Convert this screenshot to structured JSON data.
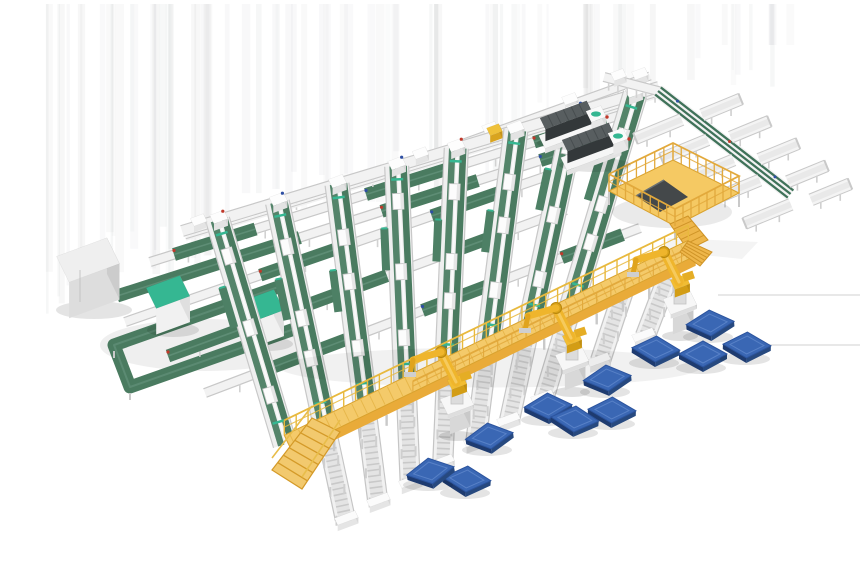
{
  "scene": {
    "canvas": {
      "width": 860,
      "height": 580,
      "background": "#ffffff"
    },
    "palette": {
      "belt_green": "#4a7b60",
      "belt_green_light": "#63927a",
      "belt_green_dark": "#3f7259",
      "teal_accent": "#35b792",
      "rail_white": "#f2f2f2",
      "rail_edge": "#c8c8c8",
      "roller_gray": "#e4e4e4",
      "walkway_deck": "#f4ca6a",
      "walkway_face": "#e9ab39",
      "walkway_trim": "#d9a22e",
      "robot_yellow": "#efb52c",
      "robot_shade": "#c79312",
      "pallet_top": "#3a67b4",
      "pallet_side_dark": "#1e3b70",
      "pallet_side": "#27497f",
      "machine_dark_top": "#585e60",
      "machine_dark_front": "#33383a",
      "machine_dark_side": "#272b2d",
      "dot_red": "#c0392b",
      "dot_blue": "#2e4fa3",
      "accent_yellow_box": "#efc13a",
      "shadow": "#000000"
    },
    "streaks": {
      "count": 78,
      "x_min": 45,
      "x_max": 790,
      "y_top": 4,
      "base_opacity": 0.032
    },
    "faint_lines": [
      {
        "x1": 718,
        "y1": 295,
        "x2": 860,
        "y2": 295
      },
      {
        "x1": 745,
        "y1": 345,
        "x2": 860,
        "y2": 345
      }
    ],
    "rows": [
      {
        "name": "infeed-line-upper",
        "p1": [
          450,
          148
        ],
        "p2": [
          650,
          76
        ],
        "w": 8,
        "boxes": [
          0.2,
          0.6,
          0.95
        ],
        "green": []
      },
      {
        "name": "cross-row-1",
        "p1": [
          150,
          262
        ],
        "p2": [
          630,
          112
        ],
        "w": 9,
        "boxes": [],
        "green": [
          [
            0.05,
            0.22
          ],
          [
            0.45,
            0.62
          ],
          [
            0.8,
            0.95
          ]
        ]
      },
      {
        "name": "cross-row-2",
        "p1": [
          117,
          296
        ],
        "p2": [
          598,
          142
        ],
        "w": 9,
        "boxes": [],
        "green": [
          [
            0.0,
            0.38
          ],
          [
            0.55,
            0.75
          ],
          [
            0.88,
            1.0
          ]
        ]
      },
      {
        "name": "cross-row-3",
        "p1": [
          125,
          322
        ],
        "p2": [
          576,
          166
        ],
        "w": 9,
        "boxes": [],
        "green": [
          [
            0.3,
            0.5
          ],
          [
            0.68,
            0.84
          ]
        ]
      },
      {
        "name": "cross-row-4",
        "p1": [
          168,
          356
        ],
        "p2": [
          566,
          210
        ],
        "w": 9,
        "boxes": [],
        "green": [
          [
            0.0,
            0.55
          ],
          [
            0.7,
            0.85
          ]
        ]
      },
      {
        "name": "cross-row-5",
        "p1": [
          205,
          393
        ],
        "p2": [
          640,
          228
        ],
        "w": 9,
        "boxes": [],
        "green": [
          [
            0.15,
            0.35
          ],
          [
            0.5,
            0.68
          ],
          [
            0.82,
            0.96
          ]
        ]
      }
    ],
    "infeed_main": {
      "name": "infeed-line-top",
      "p1": [
        182,
        231
      ],
      "p2": [
        659,
        87
      ],
      "w": 11,
      "extra_boxes": [
        0.035,
        0.5
      ],
      "yellow_box_t": 0.655
    },
    "corner_rail": {
      "p1": [
        604,
        77
      ],
      "p2": [
        662,
        92
      ],
      "w": 9,
      "box_t": 0.25
    },
    "lanes": {
      "count": 8,
      "t_start": 0.075,
      "t_step": 0.125,
      "lean_start": 0.3,
      "lean_end": -0.3,
      "width": 24,
      "shuttle_fracs": [
        0.16,
        0.44,
        0.7
      ],
      "chute_len": 42,
      "chute_offset": 15
    },
    "walkway": {
      "name": "elevated-walkway",
      "p1": [
        288,
        443
      ],
      "p2": [
        692,
        248
      ],
      "deck_w": 17,
      "face_h": 10,
      "rail_h": 15,
      "leg_step": 26,
      "stairs": [
        [
          312,
          418
        ],
        [
          340,
          432
        ],
        [
          302,
          489
        ],
        [
          272,
          470
        ]
      ],
      "end_ramp": [
        [
          688,
          241
        ],
        [
          712,
          252
        ],
        [
          700,
          266
        ],
        [
          680,
          252
        ]
      ]
    },
    "outfeeds": {
      "lane_indices": [
        1,
        2,
        3,
        4,
        5,
        6,
        7
      ],
      "extra_s": [
        0.84,
        0.96
      ],
      "length": 84,
      "width": 20
    },
    "loop": {
      "name": "left-loop-conveyor",
      "corners": [
        [
          114,
          345
        ],
        [
          284,
          285
        ],
        [
          300,
          327
        ],
        [
          130,
          387
        ]
      ],
      "belt_w": 13
    },
    "cabinet": {
      "name": "electrical-cabinet",
      "cx": 88,
      "cy": 296,
      "L": 54,
      "D": 30,
      "H": 36
    },
    "teal_boxes": [
      {
        "cx": 168,
        "cy": 318,
        "L": 36,
        "D": 24,
        "H": 26
      },
      {
        "cx": 262,
        "cy": 332,
        "L": 36,
        "D": 24,
        "H": 26
      }
    ],
    "machines": [
      {
        "name": "wrapper-machine-1",
        "cx": 569,
        "cy": 133
      },
      {
        "name": "wrapper-machine-2",
        "cx": 591,
        "cy": 155
      }
    ],
    "spur": {
      "name": "takeaway-spur-conveyor",
      "p1": [
        658,
        91
      ],
      "p2": [
        788,
        192
      ],
      "w": 14,
      "tables_low": [
        0.22,
        0.42,
        0.62,
        0.82,
        1.06
      ],
      "tables_high": [
        0.3,
        0.52,
        0.74,
        0.96,
        1.14
      ],
      "table_len_low": 50,
      "table_len_high": 42,
      "table_w": 12
    },
    "platform": {
      "name": "operator-platform",
      "floor": [
        [
          609,
          191
        ],
        [
          673,
          160
        ],
        [
          739,
          193
        ],
        [
          675,
          226
        ]
      ],
      "wedge": [
        [
          636,
          196
        ],
        [
          664,
          180
        ],
        [
          688,
          197
        ],
        [
          660,
          212
        ]
      ],
      "stairs": [
        [
          670,
          224
        ],
        [
          688,
          216
        ],
        [
          708,
          240
        ],
        [
          688,
          250
        ]
      ],
      "rail_h": 17
    },
    "robots": [
      {
        "name": "palletizing-robot-1",
        "x": 457,
        "y": 432
      },
      {
        "name": "palletizing-robot-2",
        "x": 572,
        "y": 388
      },
      {
        "name": "palletizing-robot-3",
        "x": 680,
        "y": 332
      }
    ],
    "pallets": [
      {
        "x": 710,
        "y": 321,
        "r": -4
      },
      {
        "x": 656,
        "y": 347,
        "r": 3
      },
      {
        "x": 703,
        "y": 352,
        "r": 0
      },
      {
        "x": 747,
        "y": 343,
        "r": 2
      },
      {
        "x": 607,
        "y": 376,
        "r": -6
      },
      {
        "x": 612,
        "y": 408,
        "r": 2
      },
      {
        "x": 548,
        "y": 404,
        "r": -3
      },
      {
        "x": 575,
        "y": 417,
        "r": 5
      },
      {
        "x": 489,
        "y": 434,
        "r": -8
      },
      {
        "x": 467,
        "y": 477,
        "r": 4
      },
      {
        "x": 430,
        "y": 469,
        "r": -10
      }
    ]
  }
}
